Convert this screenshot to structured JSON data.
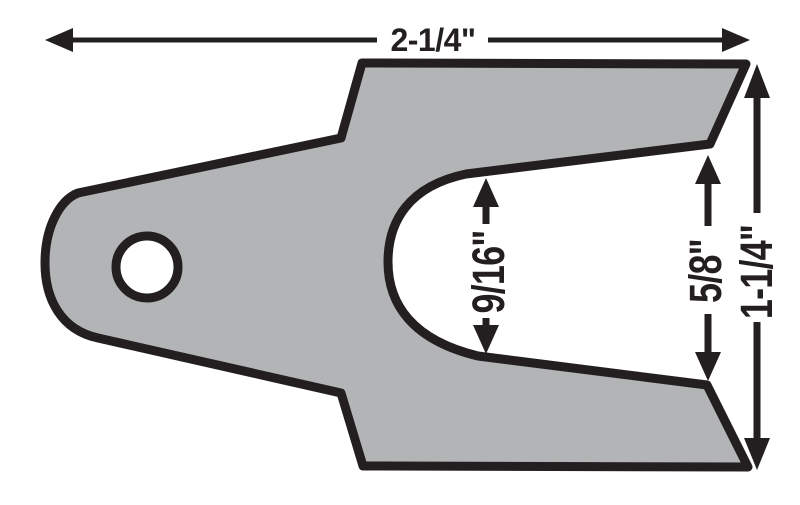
{
  "dimensions": {
    "overall_width": "2-1/4\"",
    "slot_width": "9/16\"",
    "prong_gap": "5/8\"",
    "overall_height": "1-1/4\""
  },
  "colors": {
    "body_fill": "#b2b4b6",
    "line_color": "#231f20",
    "background": "#ffffff"
  }
}
